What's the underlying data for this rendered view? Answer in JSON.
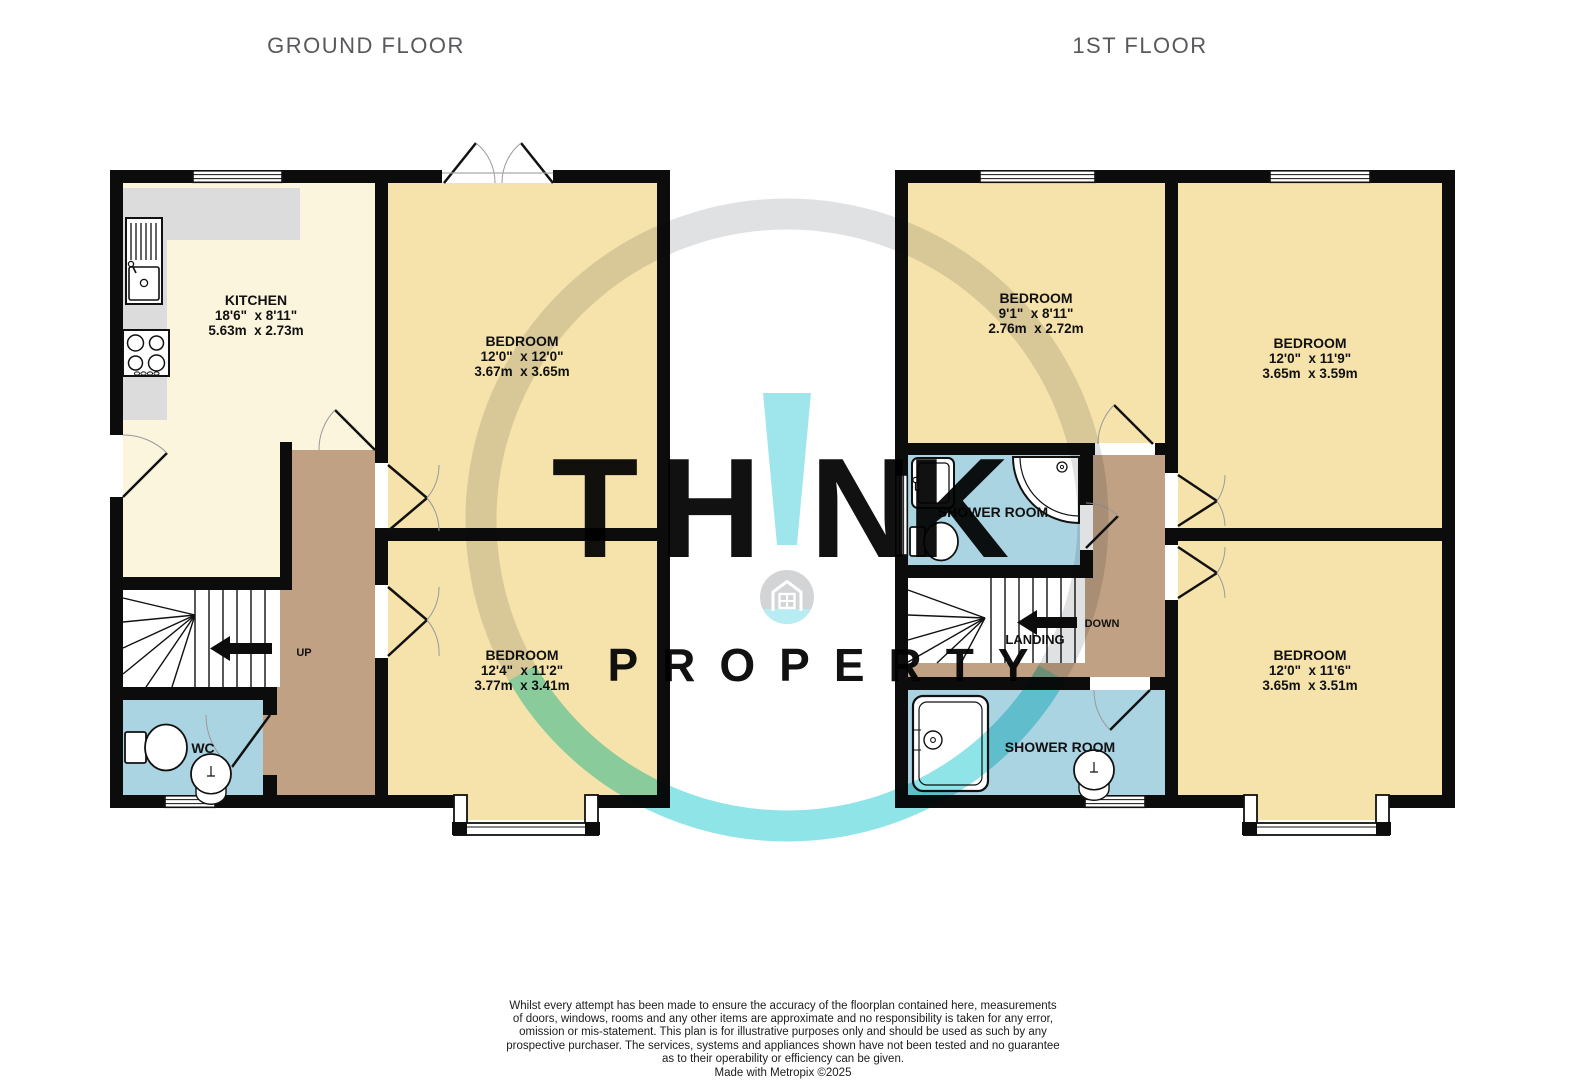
{
  "titles": {
    "ground": "GROUND FLOOR",
    "first": "1ST FLOOR"
  },
  "ground": {
    "kitchen": {
      "name": "KITCHEN",
      "imperial": "18'6\"  x 8'11\"",
      "metric": "5.63m  x 2.73m"
    },
    "bedroom_top": {
      "name": "BEDROOM",
      "imperial": "12'0\"  x 12'0\"",
      "metric": "3.67m  x 3.65m"
    },
    "bedroom_bottom": {
      "name": "BEDROOM",
      "imperial": "12'4\"  x 11'2\"",
      "metric": "3.77m  x 3.41m"
    },
    "wc": {
      "name": "WC"
    },
    "stairs_label": "UP"
  },
  "first": {
    "bedroom_small": {
      "name": "BEDROOM",
      "imperial": "9'1\"  x 8'11\"",
      "metric": "2.76m  x 2.72m"
    },
    "bedroom_top": {
      "name": "BEDROOM",
      "imperial": "12'0\"  x 11'9\"",
      "metric": "3.65m  x 3.59m"
    },
    "bedroom_bottom": {
      "name": "BEDROOM",
      "imperial": "12'0\"  x 11'6\"",
      "metric": "3.65m  x 3.51m"
    },
    "shower_room_mid": {
      "name": "SHOWER ROOM"
    },
    "shower_room_bottom": {
      "name": "SHOWER ROOM"
    },
    "landing": {
      "name": "LANDING"
    },
    "stairs_label": "DOWN"
  },
  "watermark": {
    "t": "T",
    "h": "H",
    "bang": "!",
    "n": "N",
    "k": "K",
    "property": "PROPERTY"
  },
  "disclaimer": {
    "lines": [
      "Whilst every attempt has been made to ensure the accuracy of the floorplan contained here, measurements",
      "of doors, windows, rooms and any other items are approximate and no responsibility is taken for any error,",
      "omission or mis-statement. This plan is for illustrative purposes only and should be used as such by any",
      "prospective purchaser. The services, systems and appliances shown have not been tested and no guarantee",
      "as to their operability or efficiency can be given."
    ],
    "credit": "Made with Metropix ©2025"
  },
  "colors": {
    "wall": "#0c0c0c",
    "room_yellow": "#f6e3ab",
    "kitchen_cream": "#fbf5de",
    "hall_brown": "#c0a183",
    "bath_blue": "#abd4e3",
    "counter_gray": "#dcdcdc",
    "title_gray": "#58595c",
    "watermark_gray": "#c6c7c9",
    "watermark_cyan": "#9fe6ec"
  }
}
